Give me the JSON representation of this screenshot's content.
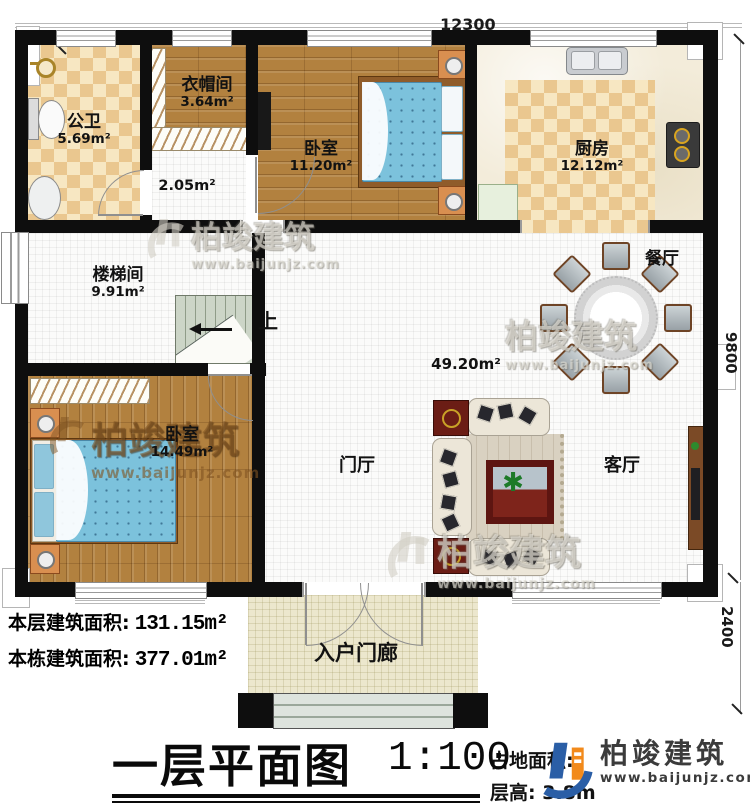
{
  "rooms": {
    "bathroom": {
      "name": "公卫",
      "area": "5.69m²"
    },
    "cloakroom": {
      "name": "衣帽间",
      "area": "3.64m²"
    },
    "hall": {
      "area": "2.05m²"
    },
    "bedroom_top": {
      "name": "卧室",
      "area": "11.20m²"
    },
    "kitchen": {
      "name": "厨房",
      "area": "12.12m²"
    },
    "stair_hall": {
      "name": "楼梯间",
      "area": "9.91m²"
    },
    "bedroom_left": {
      "name": "卧室",
      "area": "14.49m²"
    },
    "open_area": {
      "area": "49.20m²"
    },
    "dining": {
      "name": "餐厅"
    },
    "living": {
      "name": "客厅"
    },
    "foyer": {
      "name": "门厅"
    },
    "porch": {
      "name": "入户门廊"
    }
  },
  "stairs": {
    "up_label": "上"
  },
  "dimensions": {
    "top_width": "12300",
    "right_height": "9800",
    "porch_depth": "2400"
  },
  "stats": {
    "floor_area_label": "本层建筑面积:",
    "floor_area_value": "131.15m²",
    "building_area_label": "本栋建筑面积:",
    "building_area_value": "377.01m²"
  },
  "title_block": {
    "plan_title": "一层平面图",
    "scale": "1:100",
    "site_area_label": "占地面积:",
    "floor_height_label": "层高:",
    "floor_height_value": "3.8m"
  },
  "branding": {
    "name": "柏竣建筑",
    "url": "www.baijunjz.com"
  },
  "watermark": {
    "name": "柏竣建筑",
    "url": "www.baijunjz.com"
  },
  "colors": {
    "wall": "#0e0e0e",
    "wood_floor": "#b2813f",
    "checker_dark": "#eac78f",
    "checker_light": "#f7e7c2",
    "marble": "#f3ecda",
    "porch": "#ece7cd",
    "bed_blue": "#7cc2dc",
    "sofa_cream": "#ece6d8",
    "table_red": "#6b1d15",
    "logo_blue": "#2a5ea6",
    "logo_orange": "#f28a1b"
  }
}
